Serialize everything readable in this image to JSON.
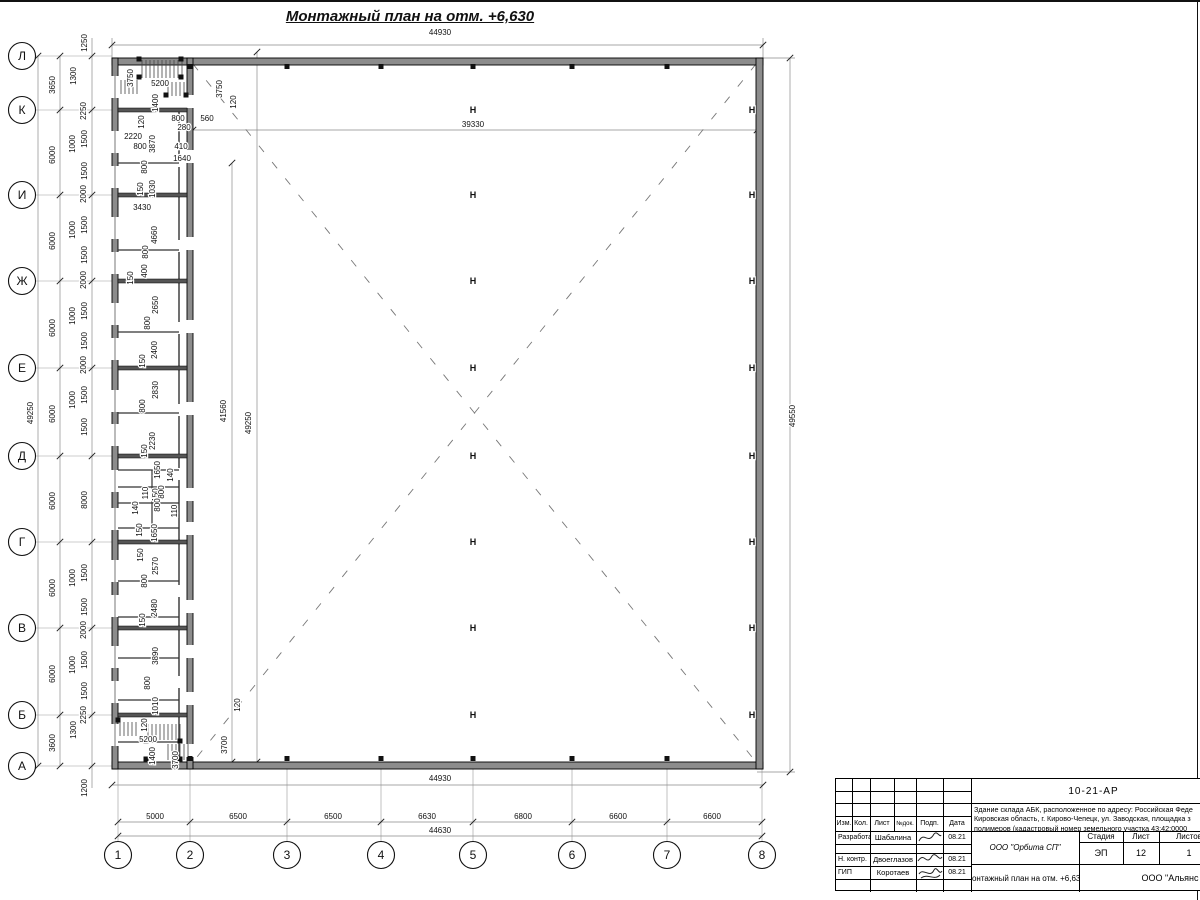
{
  "page_title": "Монтажный план на отм. +6,630",
  "axis_rows": [
    {
      "label": "Л",
      "y": 56
    },
    {
      "label": "К",
      "y": 110
    },
    {
      "label": "И",
      "y": 195
    },
    {
      "label": "Ж",
      "y": 281
    },
    {
      "label": "Е",
      "y": 368
    },
    {
      "label": "Д",
      "y": 456
    },
    {
      "label": "Г",
      "y": 542
    },
    {
      "label": "В",
      "y": 628
    },
    {
      "label": "Б",
      "y": 715
    },
    {
      "label": "А",
      "y": 766
    }
  ],
  "axis_cols": [
    {
      "label": "1",
      "x": 118
    },
    {
      "label": "2",
      "x": 190
    },
    {
      "label": "3",
      "x": 287
    },
    {
      "label": "4",
      "x": 381
    },
    {
      "label": "5",
      "x": 473
    },
    {
      "label": "6",
      "x": 572
    },
    {
      "label": "7",
      "x": 667
    },
    {
      "label": "8",
      "x": 762
    }
  ],
  "h_columns": {
    "center_x": 473,
    "wall_x": 752,
    "ys": [
      110,
      195,
      281,
      368,
      456,
      542,
      628,
      715
    ],
    "symbol": "H"
  },
  "dim_labels": [
    {
      "t": "44930",
      "x": 440,
      "y": 32,
      "r": 0
    },
    {
      "t": "44930",
      "x": 440,
      "y": 778,
      "r": 0
    },
    {
      "t": "44630",
      "x": 440,
      "y": 830,
      "r": 0
    },
    {
      "t": "5000",
      "x": 155,
      "y": 816,
      "r": 0
    },
    {
      "t": "6500",
      "x": 238,
      "y": 816,
      "r": 0
    },
    {
      "t": "6500",
      "x": 333,
      "y": 816,
      "r": 0
    },
    {
      "t": "6630",
      "x": 427,
      "y": 816,
      "r": 0
    },
    {
      "t": "6800",
      "x": 523,
      "y": 816,
      "r": 0
    },
    {
      "t": "6600",
      "x": 618,
      "y": 816,
      "r": 0
    },
    {
      "t": "6600",
      "x": 712,
      "y": 816,
      "r": 0
    },
    {
      "t": "39330",
      "x": 473,
      "y": 124,
      "r": 0
    },
    {
      "t": "560",
      "x": 207,
      "y": 118,
      "r": 0
    },
    {
      "t": "3750",
      "x": 133,
      "y": 75,
      "r": 1
    },
    {
      "t": "5200",
      "x": 160,
      "y": 83,
      "r": 0
    },
    {
      "t": "1400",
      "x": 158,
      "y": 100,
      "r": 1
    },
    {
      "t": "120",
      "x": 144,
      "y": 119,
      "r": 1
    },
    {
      "t": "800",
      "x": 178,
      "y": 118,
      "r": 0
    },
    {
      "t": "280",
      "x": 184,
      "y": 127,
      "r": 0
    },
    {
      "t": "2220",
      "x": 133,
      "y": 136,
      "r": 0
    },
    {
      "t": "800",
      "x": 140,
      "y": 146,
      "r": 0
    },
    {
      "t": "3870",
      "x": 155,
      "y": 141,
      "r": 1
    },
    {
      "t": "410",
      "x": 181,
      "y": 146,
      "r": 0
    },
    {
      "t": "1640",
      "x": 182,
      "y": 158,
      "r": 0
    },
    {
      "t": "800",
      "x": 147,
      "y": 164,
      "r": 1
    },
    {
      "t": "3750",
      "x": 222,
      "y": 86,
      "r": 1
    },
    {
      "t": "120",
      "x": 236,
      "y": 99,
      "r": 1
    },
    {
      "t": "150",
      "x": 143,
      "y": 186,
      "r": 1
    },
    {
      "t": "1030",
      "x": 155,
      "y": 186,
      "r": 1
    },
    {
      "t": "3430",
      "x": 142,
      "y": 207,
      "r": 0
    },
    {
      "t": "4660",
      "x": 157,
      "y": 232,
      "r": 1
    },
    {
      "t": "800",
      "x": 148,
      "y": 249,
      "r": 1
    },
    {
      "t": "400",
      "x": 147,
      "y": 268,
      "r": 1
    },
    {
      "t": "150",
      "x": 133,
      "y": 275,
      "r": 1
    },
    {
      "t": "2650",
      "x": 158,
      "y": 302,
      "r": 1
    },
    {
      "t": "800",
      "x": 150,
      "y": 320,
      "r": 1
    },
    {
      "t": "2400",
      "x": 157,
      "y": 347,
      "r": 1
    },
    {
      "t": "150",
      "x": 145,
      "y": 358,
      "r": 1
    },
    {
      "t": "2830",
      "x": 158,
      "y": 387,
      "r": 1
    },
    {
      "t": "800",
      "x": 145,
      "y": 403,
      "r": 1
    },
    {
      "t": "41560",
      "x": 226,
      "y": 408,
      "r": 1
    },
    {
      "t": "49250",
      "x": 251,
      "y": 420,
      "r": 1
    },
    {
      "t": "49550",
      "x": 795,
      "y": 413,
      "r": 1
    },
    {
      "t": "2230",
      "x": 155,
      "y": 438,
      "r": 1
    },
    {
      "t": "150",
      "x": 147,
      "y": 448,
      "r": 1
    },
    {
      "t": "1650",
      "x": 160,
      "y": 467,
      "r": 1
    },
    {
      "t": "140",
      "x": 173,
      "y": 472,
      "r": 1
    },
    {
      "t": "110",
      "x": 148,
      "y": 490,
      "r": 1
    },
    {
      "t": "150",
      "x": 158,
      "y": 492,
      "r": 1
    },
    {
      "t": "800",
      "x": 164,
      "y": 489,
      "r": 1
    },
    {
      "t": "140",
      "x": 138,
      "y": 505,
      "r": 1
    },
    {
      "t": "800",
      "x": 160,
      "y": 502,
      "r": 1
    },
    {
      "t": "110",
      "x": 177,
      "y": 508,
      "r": 1
    },
    {
      "t": "150",
      "x": 142,
      "y": 527,
      "r": 1
    },
    {
      "t": "1650",
      "x": 157,
      "y": 530,
      "r": 1
    },
    {
      "t": "150",
      "x": 143,
      "y": 552,
      "r": 1
    },
    {
      "t": "2570",
      "x": 158,
      "y": 563,
      "r": 1
    },
    {
      "t": "800",
      "x": 147,
      "y": 578,
      "r": 1
    },
    {
      "t": "2480",
      "x": 157,
      "y": 605,
      "r": 1
    },
    {
      "t": "150",
      "x": 145,
      "y": 617,
      "r": 1
    },
    {
      "t": "3890",
      "x": 158,
      "y": 653,
      "r": 1
    },
    {
      "t": "800",
      "x": 150,
      "y": 680,
      "r": 1
    },
    {
      "t": "1010",
      "x": 158,
      "y": 703,
      "r": 1
    },
    {
      "t": "120",
      "x": 147,
      "y": 722,
      "r": 1
    },
    {
      "t": "5200",
      "x": 148,
      "y": 739,
      "r": 0
    },
    {
      "t": "1400",
      "x": 155,
      "y": 753,
      "r": 1
    },
    {
      "t": "3700",
      "x": 178,
      "y": 757,
      "r": 1
    },
    {
      "t": "120",
      "x": 240,
      "y": 702,
      "r": 1
    },
    {
      "t": "3700",
      "x": 227,
      "y": 742,
      "r": 1
    },
    {
      "t": "49250",
      "x": 33,
      "y": 410,
      "r": 1
    },
    {
      "t": "3650",
      "x": 55,
      "y": 82,
      "r": 1
    },
    {
      "t": "6000",
      "x": 55,
      "y": 152,
      "r": 1
    },
    {
      "t": "6000",
      "x": 55,
      "y": 238,
      "r": 1
    },
    {
      "t": "6000",
      "x": 55,
      "y": 325,
      "r": 1
    },
    {
      "t": "6000",
      "x": 55,
      "y": 411,
      "r": 1
    },
    {
      "t": "6000",
      "x": 55,
      "y": 498,
      "r": 1
    },
    {
      "t": "6000",
      "x": 55,
      "y": 585,
      "r": 1
    },
    {
      "t": "6000",
      "x": 55,
      "y": 671,
      "r": 1
    },
    {
      "t": "3600",
      "x": 55,
      "y": 740,
      "r": 1
    },
    {
      "t": "1250",
      "x": 87,
      "y": 40,
      "r": 1
    },
    {
      "t": "1300",
      "x": 76,
      "y": 73,
      "r": 1
    },
    {
      "t": "2250",
      "x": 86,
      "y": 108,
      "r": 1
    },
    {
      "t": "1500",
      "x": 87,
      "y": 136,
      "r": 1
    },
    {
      "t": "1000",
      "x": 75,
      "y": 141,
      "r": 1
    },
    {
      "t": "1500",
      "x": 87,
      "y": 168,
      "r": 1
    },
    {
      "t": "2000",
      "x": 86,
      "y": 191,
      "r": 1
    },
    {
      "t": "1500",
      "x": 87,
      "y": 222,
      "r": 1
    },
    {
      "t": "1000",
      "x": 75,
      "y": 227,
      "r": 1
    },
    {
      "t": "1500",
      "x": 87,
      "y": 252,
      "r": 1
    },
    {
      "t": "2000",
      "x": 86,
      "y": 277,
      "r": 1
    },
    {
      "t": "1500",
      "x": 87,
      "y": 308,
      "r": 1
    },
    {
      "t": "1000",
      "x": 75,
      "y": 313,
      "r": 1
    },
    {
      "t": "1500",
      "x": 87,
      "y": 338,
      "r": 1
    },
    {
      "t": "2000",
      "x": 86,
      "y": 362,
      "r": 1
    },
    {
      "t": "1500",
      "x": 87,
      "y": 392,
      "r": 1
    },
    {
      "t": "1000",
      "x": 75,
      "y": 397,
      "r": 1
    },
    {
      "t": "1500",
      "x": 87,
      "y": 424,
      "r": 1
    },
    {
      "t": "8000",
      "x": 87,
      "y": 497,
      "r": 1
    },
    {
      "t": "1500",
      "x": 87,
      "y": 570,
      "r": 1
    },
    {
      "t": "1000",
      "x": 75,
      "y": 575,
      "r": 1
    },
    {
      "t": "1500",
      "x": 87,
      "y": 604,
      "r": 1
    },
    {
      "t": "2000",
      "x": 86,
      "y": 627,
      "r": 1
    },
    {
      "t": "1500",
      "x": 87,
      "y": 657,
      "r": 1
    },
    {
      "t": "1000",
      "x": 75,
      "y": 662,
      "r": 1
    },
    {
      "t": "1500",
      "x": 87,
      "y": 688,
      "r": 1
    },
    {
      "t": "2250",
      "x": 86,
      "y": 712,
      "r": 1
    },
    {
      "t": "1300",
      "x": 76,
      "y": 727,
      "r": 1
    },
    {
      "t": "1200",
      "x": 87,
      "y": 785,
      "r": 1
    }
  ],
  "titleblock": {
    "doc_number": "10-21-АР",
    "address_line1": "Здание склада АБК, расположенное по адресу: Российская Феде",
    "address_line2": "Кировская область, г. Кирово-Чепецк, ул. Заводская, площадка з",
    "address_line3": "полимеров (кадастровый номер земельного участка 43:42:0000",
    "header_cols": {
      "izm": "Изм.",
      "kol": "Кол.",
      "list": "Лист",
      "ndok": "№док.",
      "podp": "Подп.",
      "data": "Дата"
    },
    "rows": [
      {
        "role": "Разработал",
        "name": "Шабалина",
        "date": "08.21"
      },
      {
        "role": "Н. контр.",
        "name": "Двоеглазов",
        "date": "08.21"
      },
      {
        "role": "ГИП",
        "name": "Коротаев",
        "date": "08.21"
      }
    ],
    "org": "ООО \"Орбита СП\"",
    "stage_label": "Стадия",
    "sheet_label": "Лист",
    "sheets_label": "Листов",
    "stage": "ЭП",
    "sheet": "12",
    "sheets": "1",
    "doc_title": "Монтажный план на отм. +6,630",
    "company": "ООО \"Альянс"
  }
}
